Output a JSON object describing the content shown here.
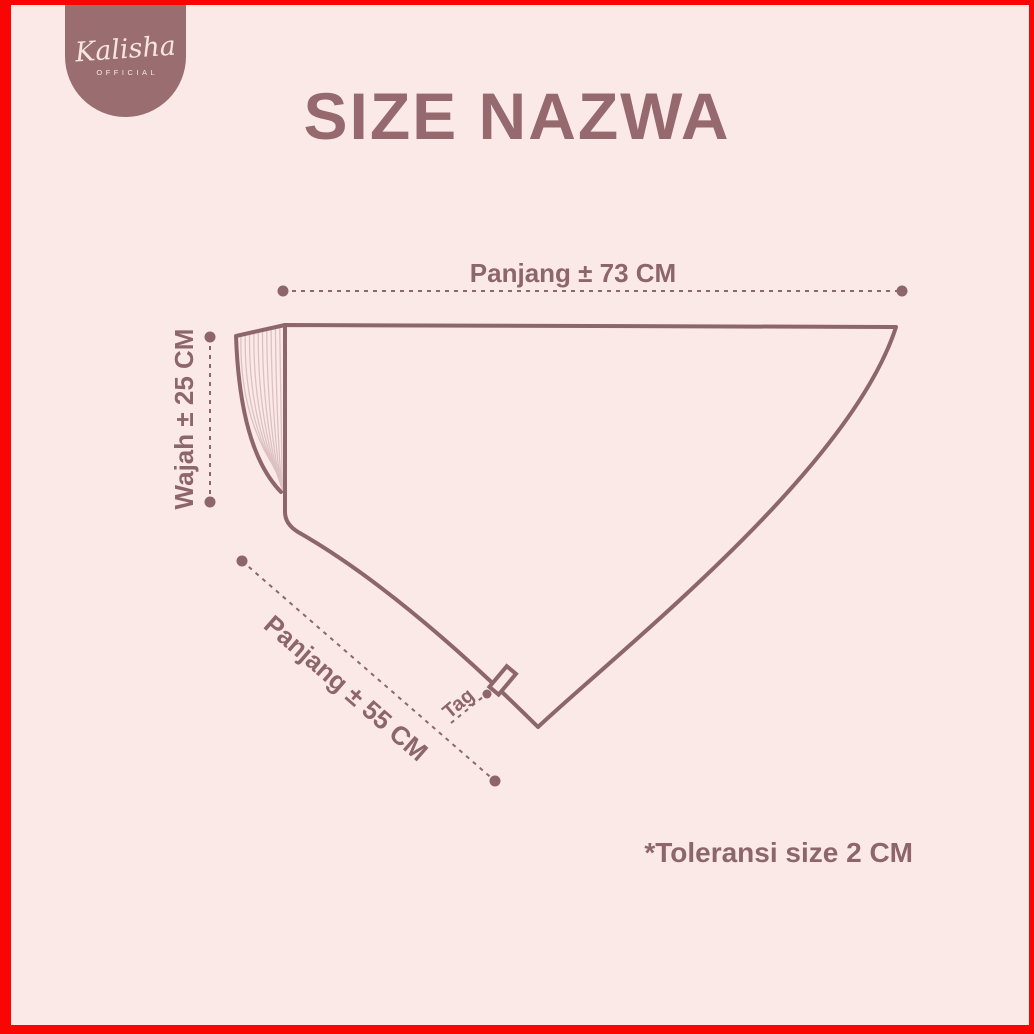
{
  "colors": {
    "background": "#fbe9e8",
    "border": "#f90604",
    "accent": "#8d666a",
    "title": "#95696d",
    "badge": "#9a6e70",
    "pleat": "#dcc0c2"
  },
  "logo": {
    "brand": "Kalisha",
    "subtitle": "OFFICIAL"
  },
  "title": {
    "text": "SIZE NAZWA"
  },
  "diagram": {
    "product": "hijab-instan-pattern",
    "measurements": {
      "top": {
        "label": "Panjang ± 73 CM",
        "value_cm": 73
      },
      "left": {
        "label": "Wajah ± 25 CM",
        "value_cm": 25
      },
      "diagonal": {
        "label": "Panjang ± 55 CM",
        "value_cm": 55
      }
    },
    "tag_label": "Tag"
  },
  "footnote": {
    "text": "*Toleransi size 2 CM"
  }
}
